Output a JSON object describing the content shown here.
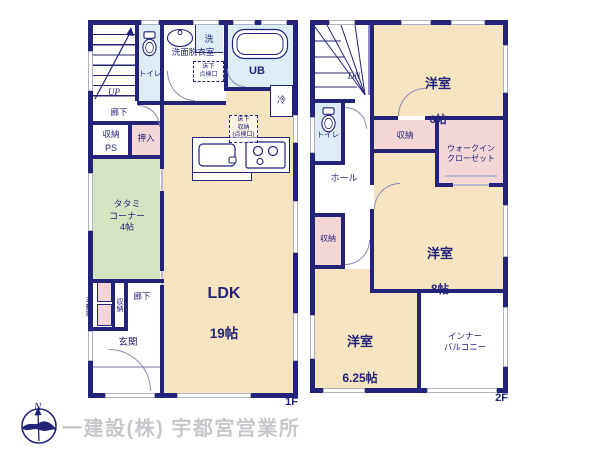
{
  "floor1": {
    "tag": "1F",
    "stairs": "UP",
    "hallway_top": "廊下",
    "toilet": "トイレ",
    "laundry": "洗",
    "washroom": "洗面脱衣室",
    "underfloor_hatch": "床下\n点検口",
    "bath": "UB",
    "fridge": "冷",
    "underfloor_storage": "床下\n収納\n(点検口)",
    "storage_top": "収納",
    "pipe_space": "PS",
    "oshiire": "押入",
    "tatami": "タタミ\nコーナー\n4帖",
    "movable_shelf": "可動棚",
    "storage_bottom": "収納",
    "hallway_bottom": "廊下",
    "entrance": "玄関",
    "ldk": {
      "name": "LDK",
      "size": "19帖"
    }
  },
  "floor2": {
    "tag": "2F",
    "stairs": "DN",
    "toilet": "トイレ",
    "hall": "ホール",
    "storage_left": "収納",
    "storage_top": "収納",
    "walk_in_closet": "ウォークイン\nクローゼット",
    "bedroom6": {
      "name": "洋室",
      "size": "6帖"
    },
    "bedroom8": {
      "name": "洋室",
      "size": "8帖"
    },
    "bedroom625": {
      "name": "洋室",
      "size": "6.25帖"
    },
    "inner_balcony": "インナー\nバルコニー"
  },
  "footer": {
    "company": "一建設(株) 宇都宮営業所",
    "compass_north": "N"
  },
  "colors": {
    "wall": "#23237a",
    "room_beige": "#f5e4bf",
    "room_green": "#d7e4c1",
    "room_pink": "#f5d6d6",
    "room_blue": "#dcedf6",
    "company_text": "#c7c7cb"
  }
}
